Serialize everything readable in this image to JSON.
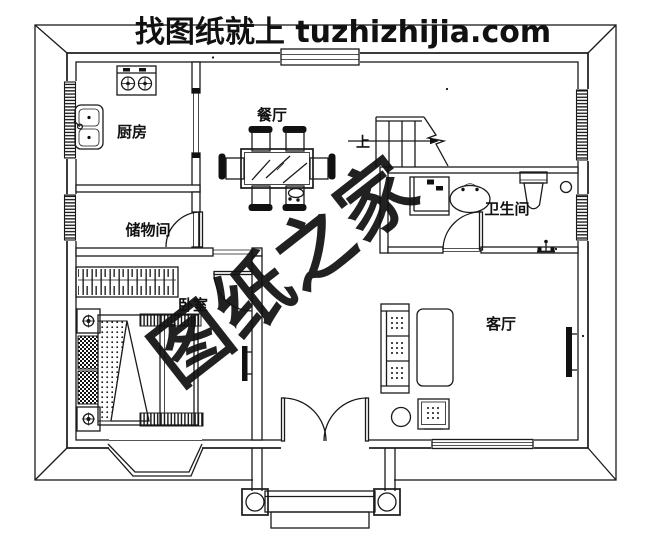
{
  "title": {
    "text": "找图纸就上 tuzhizhijia.com",
    "color": "#ee1409"
  },
  "watermark": {
    "text": "图纸之家",
    "color": "#dd3526"
  },
  "rooms": {
    "kitchen": "厨房",
    "dining": "餐厅",
    "storage": "储物间",
    "bedroom": "卧室",
    "bathroom": "卫生间",
    "living": "客厅"
  },
  "stairs": {
    "up_label": "上"
  },
  "colors": {
    "line": "#1a1a1a",
    "background": "#ffffff"
  }
}
